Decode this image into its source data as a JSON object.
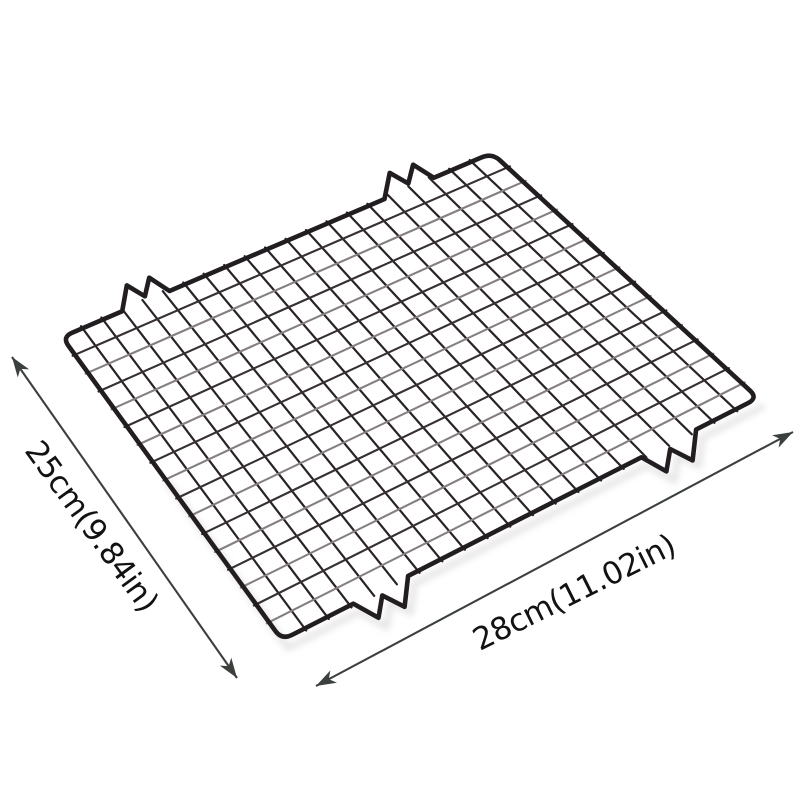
{
  "background_color": "#ffffff",
  "annotations": {
    "arrow_color": "#3c403c",
    "text_color": "#121212",
    "side_dimension": {
      "label": "25cm(9.84in)"
    },
    "bottom_dimension": {
      "label": "28cm(11.02in)"
    }
  },
  "rack": {
    "columns": 21,
    "rows": 17,
    "wire_color_dark": "#292327",
    "wire_color_mid": "#362f33",
    "wire_color_light": "#857f82",
    "border_color": "#221d20",
    "shadow_color": "#d8d8d8"
  }
}
